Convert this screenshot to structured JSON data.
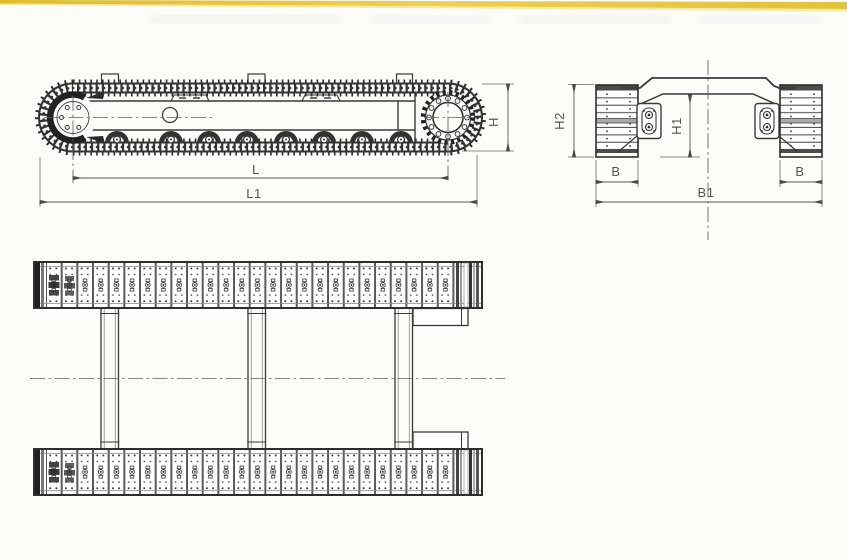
{
  "colors": {
    "paper": "#fcfcf8",
    "accent_strip": "#e4c339",
    "line": "#3a3a3a",
    "dim_text": "#555555"
  },
  "dimension_labels": {
    "H": "H",
    "L": "L",
    "L1": "L1",
    "H1": "H1",
    "H2": "H2",
    "B": "B",
    "B1": "B1"
  }
}
